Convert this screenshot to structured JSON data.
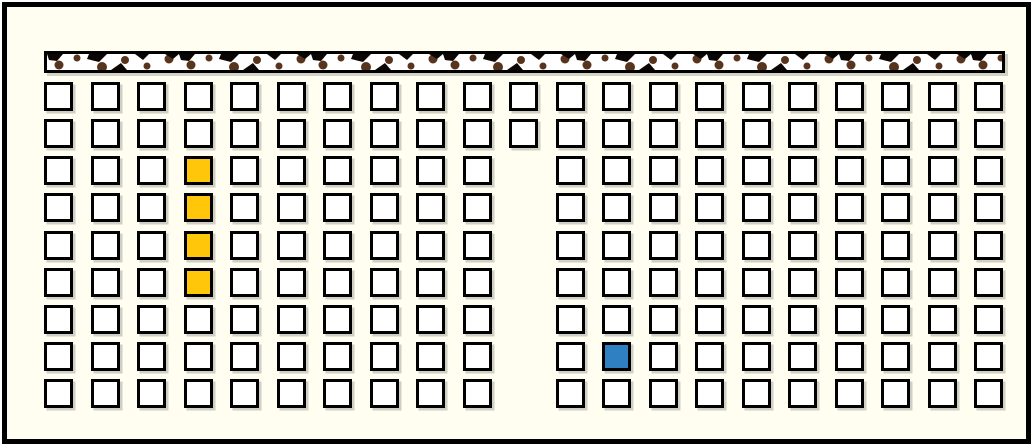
{
  "board": {
    "background_color": "#FFFEF0",
    "frame_color": "#000000",
    "wall_strip": {
      "fill_color": "#FFFFFF",
      "border_color": "#000000",
      "speckle_color": "#59341D",
      "notch_color": "#0B0603"
    },
    "grid": {
      "columns": 21,
      "rows": 9,
      "cell_fill_color": "#FFFFFF",
      "cell_border_color": "#000000",
      "missing_cells": [
        {
          "col": 11,
          "rows": [
            3,
            4,
            5,
            6,
            7,
            8,
            9
          ]
        }
      ],
      "highlighted_cells": [
        {
          "col": 4,
          "row": 3,
          "color": "#FFC60A",
          "kind": "yellow"
        },
        {
          "col": 4,
          "row": 4,
          "color": "#FFC60A",
          "kind": "yellow"
        },
        {
          "col": 4,
          "row": 5,
          "color": "#FFC60A",
          "kind": "yellow"
        },
        {
          "col": 4,
          "row": 6,
          "color": "#FFC60A",
          "kind": "yellow"
        },
        {
          "col": 13,
          "row": 8,
          "color": "#2E80C3",
          "kind": "blue"
        }
      ],
      "counts": {
        "total_cells": 182,
        "yellow_cells": 4,
        "blue_cells": 1,
        "white_cells": 177
      }
    }
  }
}
